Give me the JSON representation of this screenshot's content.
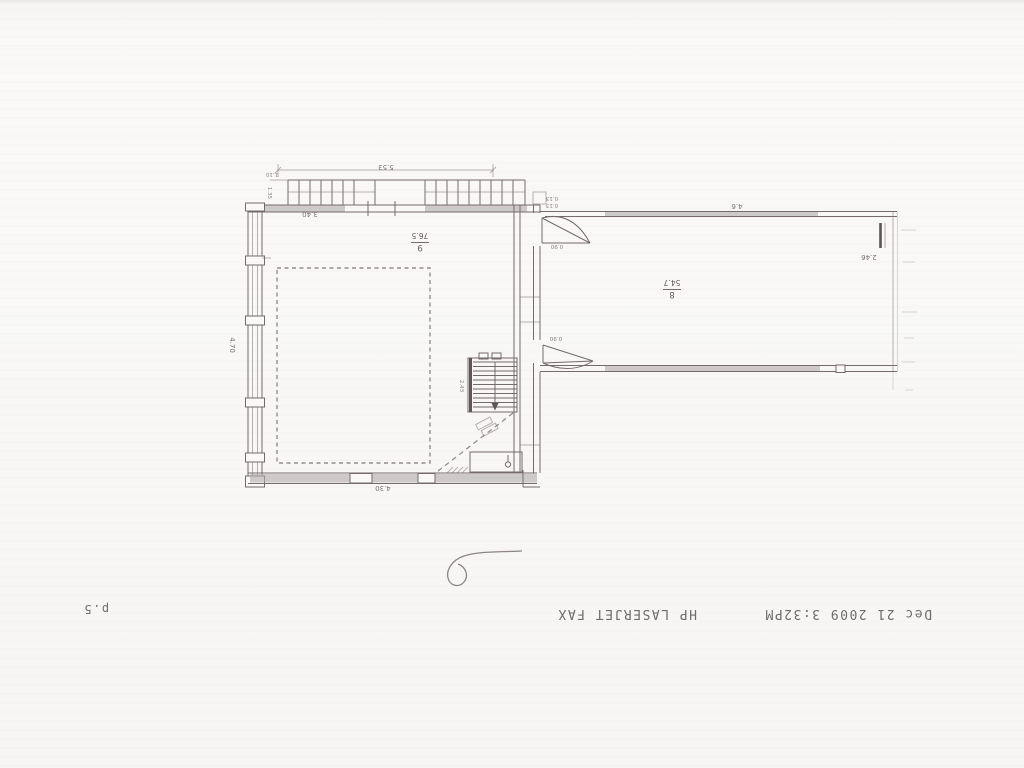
{
  "page": {
    "page_number": "p.5"
  },
  "fax_header": {
    "timestamp": "Dec 21 2009 3:32PM",
    "device": "HP LASERJET FAX"
  },
  "floor_plan": {
    "room_9": {
      "number": "9",
      "area": "76.5"
    },
    "room_8": {
      "number": "8",
      "area": "54.7"
    },
    "dims": {
      "balcony_width": "5.53",
      "balcony_d1": "1.10",
      "balcony_d2": "1.35",
      "top_wall": "3.40",
      "left_wall": "4.70",
      "bottom_wall": "4.30",
      "stairs": "2.43",
      "door_top": "0.90",
      "door_bottom": "0.90",
      "room8_top_wall": "4.6",
      "room8_right_wall": "2.46",
      "wall_thickness_a": "0.13",
      "wall_thickness_b": "0.13"
    }
  }
}
